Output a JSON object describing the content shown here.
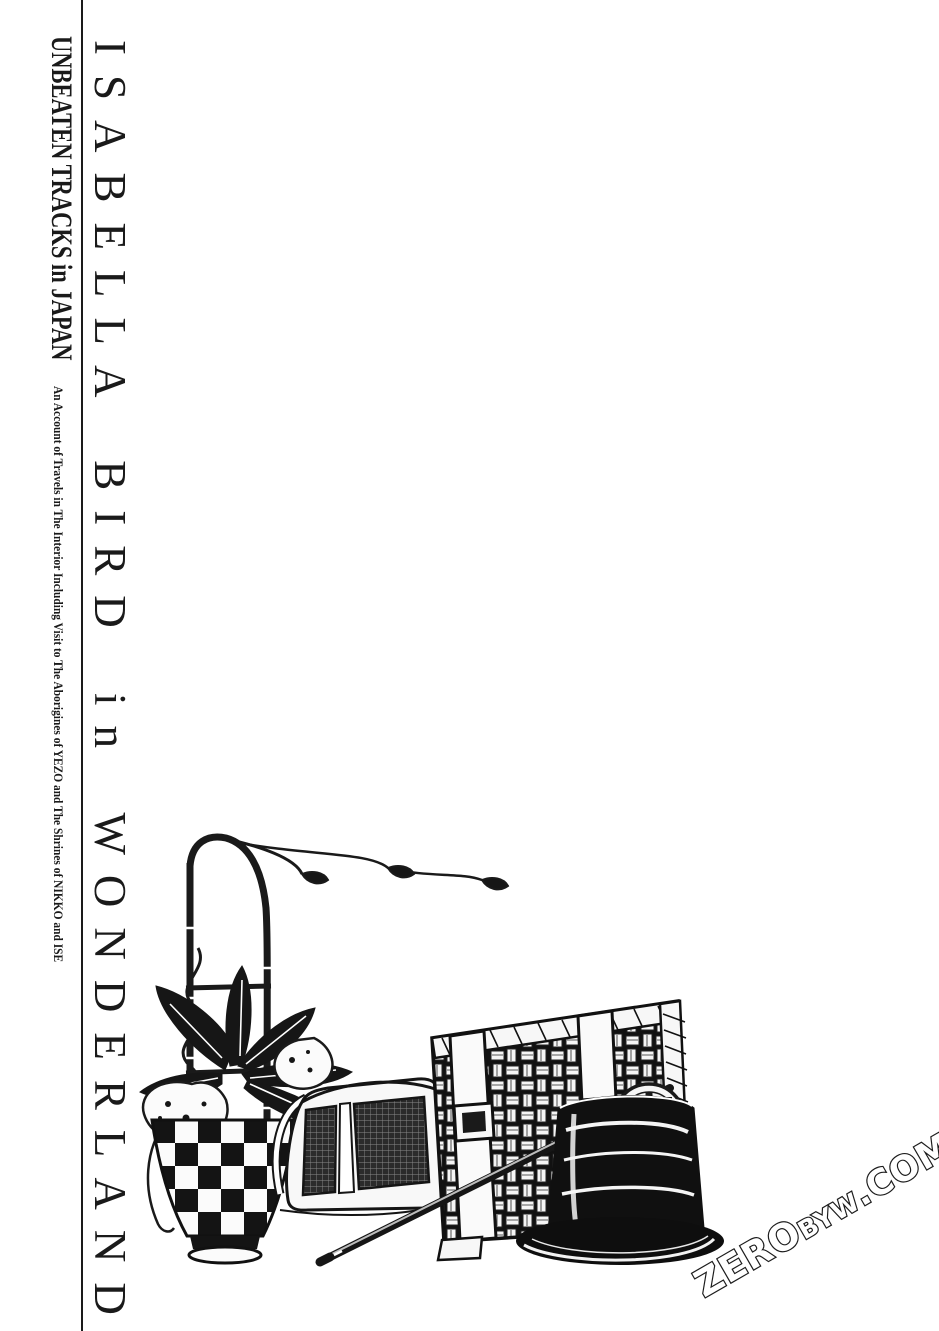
{
  "page": {
    "kind": "manga-title-page",
    "colors": {
      "paper": "#ffffff",
      "ink": "#1a1a1a"
    }
  },
  "title": {
    "main": "ISABELLA BIRD in WONDERLAND"
  },
  "spine": {
    "series_title": "UNBEATEN TRACKS in JAPAN",
    "subtitle": "An Account of Travels in The Interior Including Visit to The Aborigines of YEZO and The Shrines of NIKKO and ISE"
  },
  "illustration": {
    "items": [
      "bamboo-trellis-with-vine",
      "spotted-leaf-plant",
      "checkered-flower-pot",
      "folding-mesh-lantern",
      "wicker-travel-trunk-with-straps",
      "walking-stick",
      "ornate-medal",
      "silk-top-hat"
    ]
  },
  "watermark": {
    "zero": "ZERO",
    "byw": "BYW",
    "com": ".COM"
  }
}
